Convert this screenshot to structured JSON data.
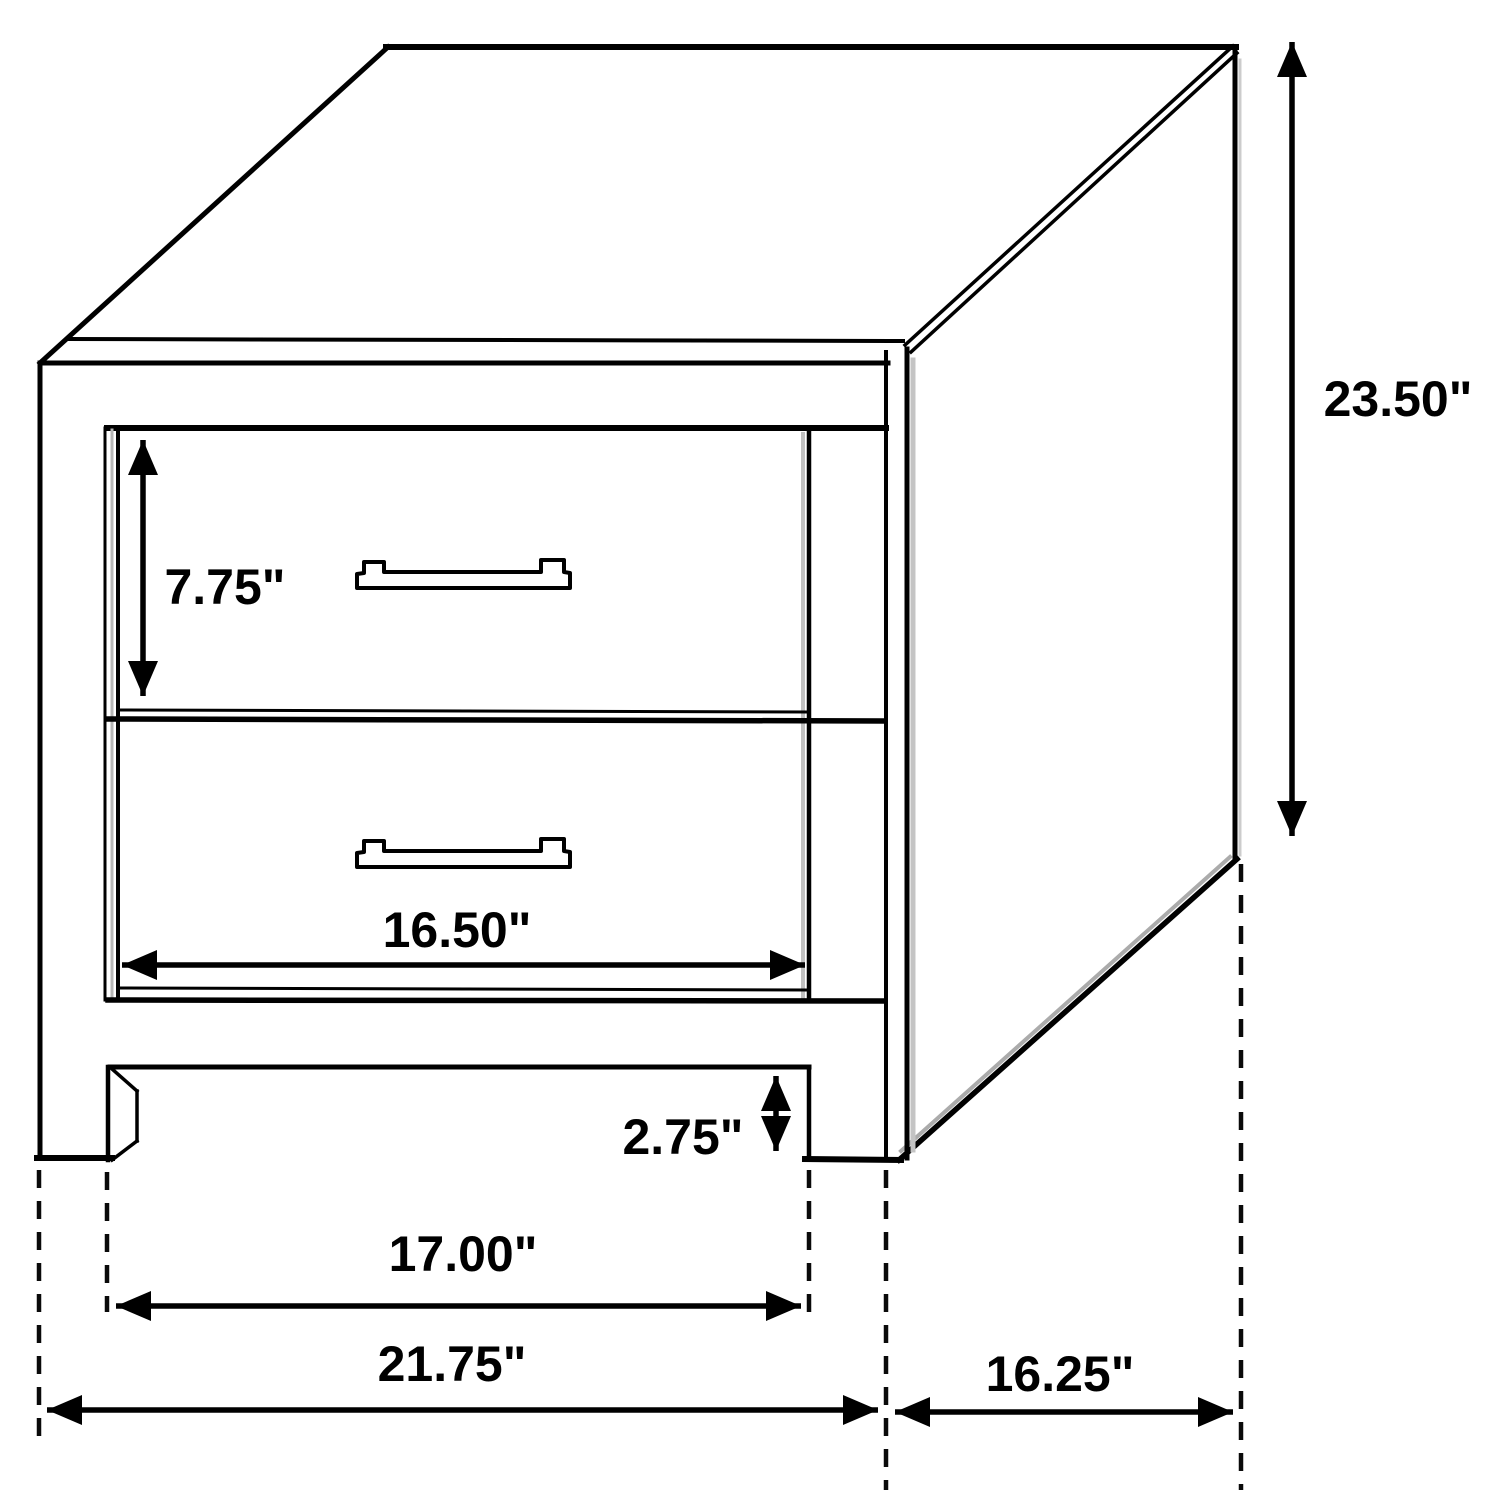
{
  "diagram": {
    "type": "furniture-dimension-line-drawing",
    "subject": "two-drawer nightstand shown in isometric view with dimension arrows",
    "unit": "inches",
    "colors": {
      "background": "#ffffff",
      "line": "#000000",
      "shadow_gray": "#bdbdbd"
    },
    "dimensions": {
      "overall_height_label": "23.50\"",
      "top_drawer_height_label": "7.75\"",
      "drawer_front_width_label": "16.50\"",
      "leg_height_label": "2.75\"",
      "inner_leg_span_label": "17.00\"",
      "overall_width_label": "21.75\"",
      "side_depth_label": "16.25\""
    },
    "parts": {
      "drawer_count": 2,
      "handle_count": 2
    }
  }
}
